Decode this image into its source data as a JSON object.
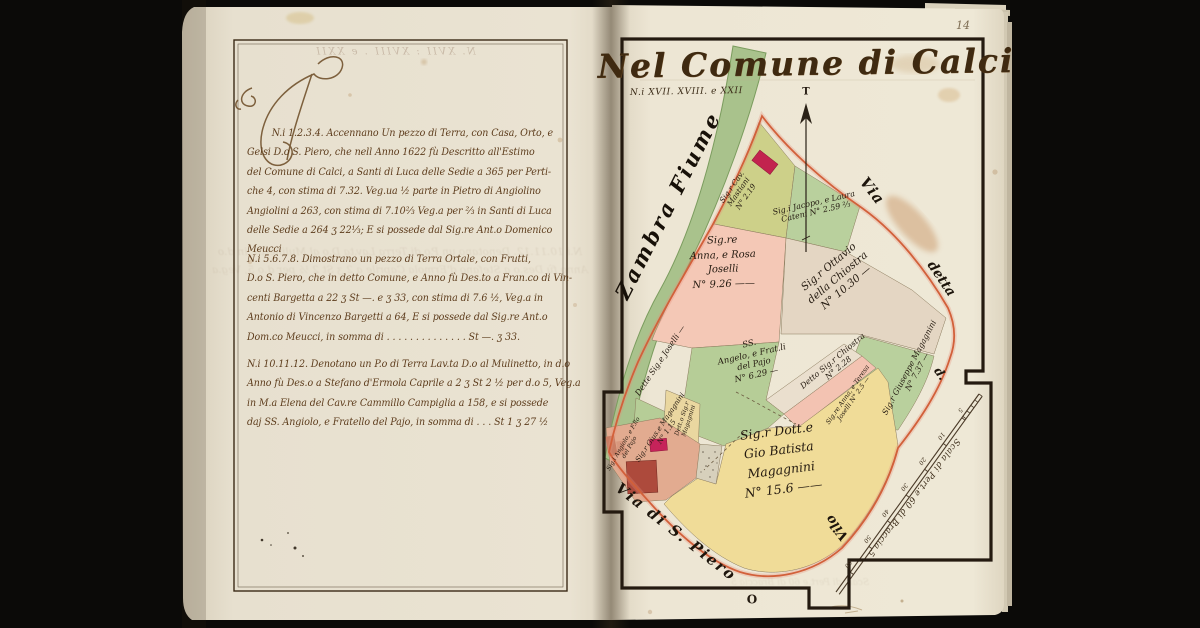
{
  "colors": {
    "background": "#0b0a08",
    "paper_left": "#e7e0cf",
    "paper_right": "#ede6d4",
    "ink": "#5d3c1c",
    "ink_dark": "#241a10",
    "frame": "#332514",
    "boundary_red": "#d2603a",
    "river_green": "#a9c28c",
    "parcel_pink": "#f4c8b6",
    "parcel_green": "#b7cd97",
    "parcel_olive": "#cdd089",
    "parcel_tan": "#e4d6c3",
    "parcel_yellow": "#f0dc98",
    "building_crimson": "#c2234e",
    "building_brick": "#ad4a3c"
  },
  "left_page": {
    "bleed_header": "N. XVII : XVIII . e XXII",
    "paragraphs": [
      {
        "lines": [
          "N.i 1.2.3.4. Accennano Un pezzo di Terra, con Casa, Orto, e",
          "Gelsi D.o S. Piero, che nell Anno 1622 fù Descritto all'Estimo",
          "del Comune di Calci, a Santi di Luca delle Sedie a 365 per Perti-",
          "che 4, con stima di 7.32. Veg.ua ½ parte in Pietro di Angiolino",
          "Angiolini a 263, con stima di 7.10⅔ Veg.a per ⅔ in Santi di Luca",
          "delle Sedie a 264 ʒ 22⅓; E si possede dal Sig.re Ant.o Domenico",
          "Meucci"
        ]
      },
      {
        "lines": [
          "N.i 5.6.7.8. Dimostrano un pezzo di Terra Ortale, con Frutti,",
          "D.o S. Piero, che in detto Comune, e Anno fù Des.to a Fran.co di Vin-",
          "centi Bargetta a 22 ʒ St —. e ʒ 33, con stima di 7.6 ½, Veg.a in",
          "Antonio di Vincenzo Bargetti a 64, E si possede dal Sig.re Ant.o",
          "Dom.co Meucci, in somma di . . . . . . . . . . . . . .   St —. ʒ 33."
        ]
      },
      {
        "lines": [
          "N.i 10.11.12. Denotano un P.o di Terra Lav.ta D.o al Mulinetto, in d.o",
          "Anno fù Des.o a Stefano d'Ermola Caprile a 2 ʒ St 2 ½ per d.o 5, Veg.a",
          "in M.a Elena del Cav.re Cammillo Campiglia a 158, e si possede",
          "daj SS. Angiolo, e Fratello del Pajo, in somma di . . .   St 1 ʒ 27 ½"
        ]
      }
    ]
  },
  "map_page": {
    "page_number": "14",
    "title": "Nel Comune di Calci",
    "subtitle": "N.i XVII. XVIII. e XXII",
    "compass": {
      "north": "T",
      "south": "O"
    },
    "river_label": "Zambra Fiume",
    "roads": {
      "via": "Via",
      "detta": "detta",
      "d": "d.",
      "vilo": "Vilo",
      "san_piero": "Via di S. Piero"
    },
    "scale": {
      "label": "Scala di Pert.e 60 di Braccia 5",
      "ticks": [
        "5",
        "10",
        "20",
        "30",
        "40",
        "50",
        "60"
      ]
    },
    "parcels": [
      {
        "name": "mastiani",
        "lines": [
          "Sig.r Cav.",
          "Mastiani",
          "N° 2.19"
        ]
      },
      {
        "name": "cateni",
        "lines": [
          "Sig.i Jacopo, e Laura",
          "Cateni N° 2.59 ⅔"
        ]
      },
      {
        "name": "joselli",
        "lines": [
          "Sig.re",
          "Anna, e Rosa",
          "Joselli",
          "N° 9.26 ——"
        ]
      },
      {
        "name": "della-chiostra",
        "lines": [
          "Sig.r Ottavio",
          "della Chiostra",
          "N° 10.30 —"
        ]
      },
      {
        "name": "del-pajo",
        "lines": [
          "SS.",
          "Angelo, e Frat.li",
          "del Pajo",
          "N° 6.29 —"
        ]
      },
      {
        "name": "detto-chiostra",
        "lines": [
          "Detto Sig.r Chiostra",
          "N° 2.28"
        ]
      },
      {
        "name": "joselli-teresa",
        "lines": [
          "Sig.re Anna, e Teresa",
          "Joselli N° 2.5 —"
        ]
      },
      {
        "name": "giuseppe-magagnini",
        "lines": [
          "Sig.r Giuseppe Magagnini",
          "N° 7.37 —"
        ]
      },
      {
        "name": "gio-batista-magagnini",
        "lines": [
          "Sig.r Dott.e",
          "Gio Batista",
          "Magagnini",
          "N° 15.6 ——"
        ]
      },
      {
        "name": "dette-joselli",
        "lines": [
          "Dette Sig.e Joselli —"
        ]
      },
      {
        "name": "gius-magagnini",
        "lines": [
          "Sig.r Gius.e Magagnini",
          "N° 1.15"
        ]
      },
      {
        "name": "angiolo-pajo",
        "lines": [
          "Sig.i Angiolo, e F.llo",
          "del Pajo"
        ]
      },
      {
        "name": "detto-magagnini",
        "lines": [
          "Dett.o Sig.r",
          "Magagnini"
        ]
      }
    ]
  }
}
